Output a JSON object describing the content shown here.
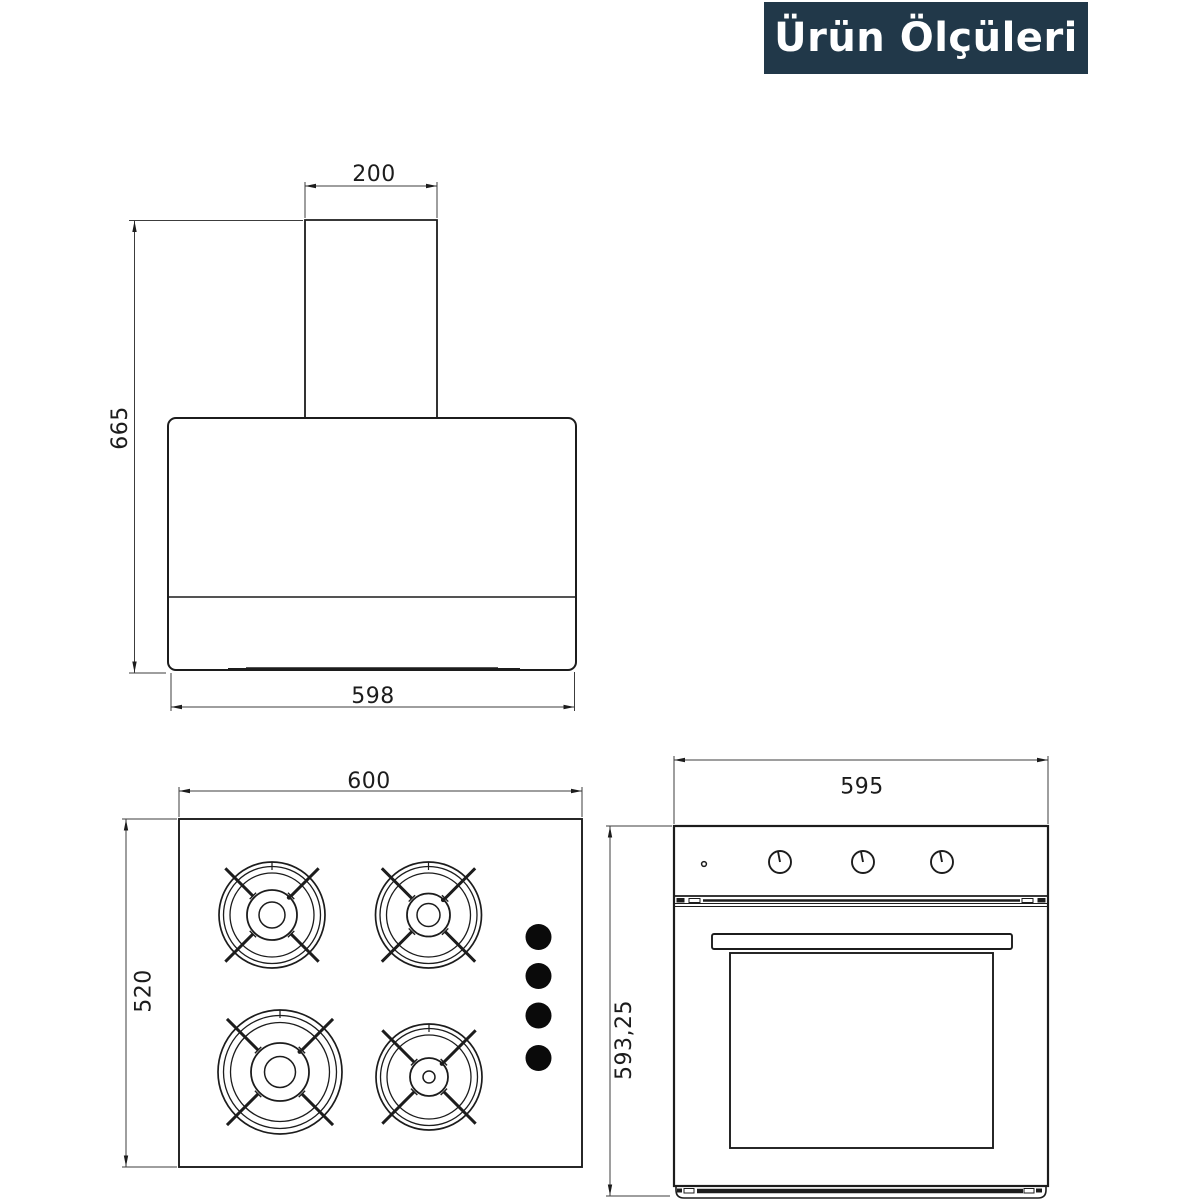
{
  "page": {
    "background": "#ffffff",
    "line_color": "#1c1c1c"
  },
  "header": {
    "badge_label": "Ürün Ölçüleri",
    "badge_bg": "#213849",
    "badge_text_color": "#ffffff"
  },
  "drawings": {
    "hood": {
      "label": "range hood front view",
      "dims": {
        "chimney_width_mm": "200",
        "total_height_mm": "665",
        "body_width_mm": "598"
      }
    },
    "cooktop": {
      "label": "gas hob top view",
      "dims": {
        "width_mm": "600",
        "depth_mm": "520"
      },
      "burner_count": 4,
      "knob_count": 4
    },
    "oven": {
      "label": "built-in oven front view",
      "dims": {
        "width_mm": "595",
        "height_mm": "593,25"
      },
      "knob_count": 3
    }
  }
}
